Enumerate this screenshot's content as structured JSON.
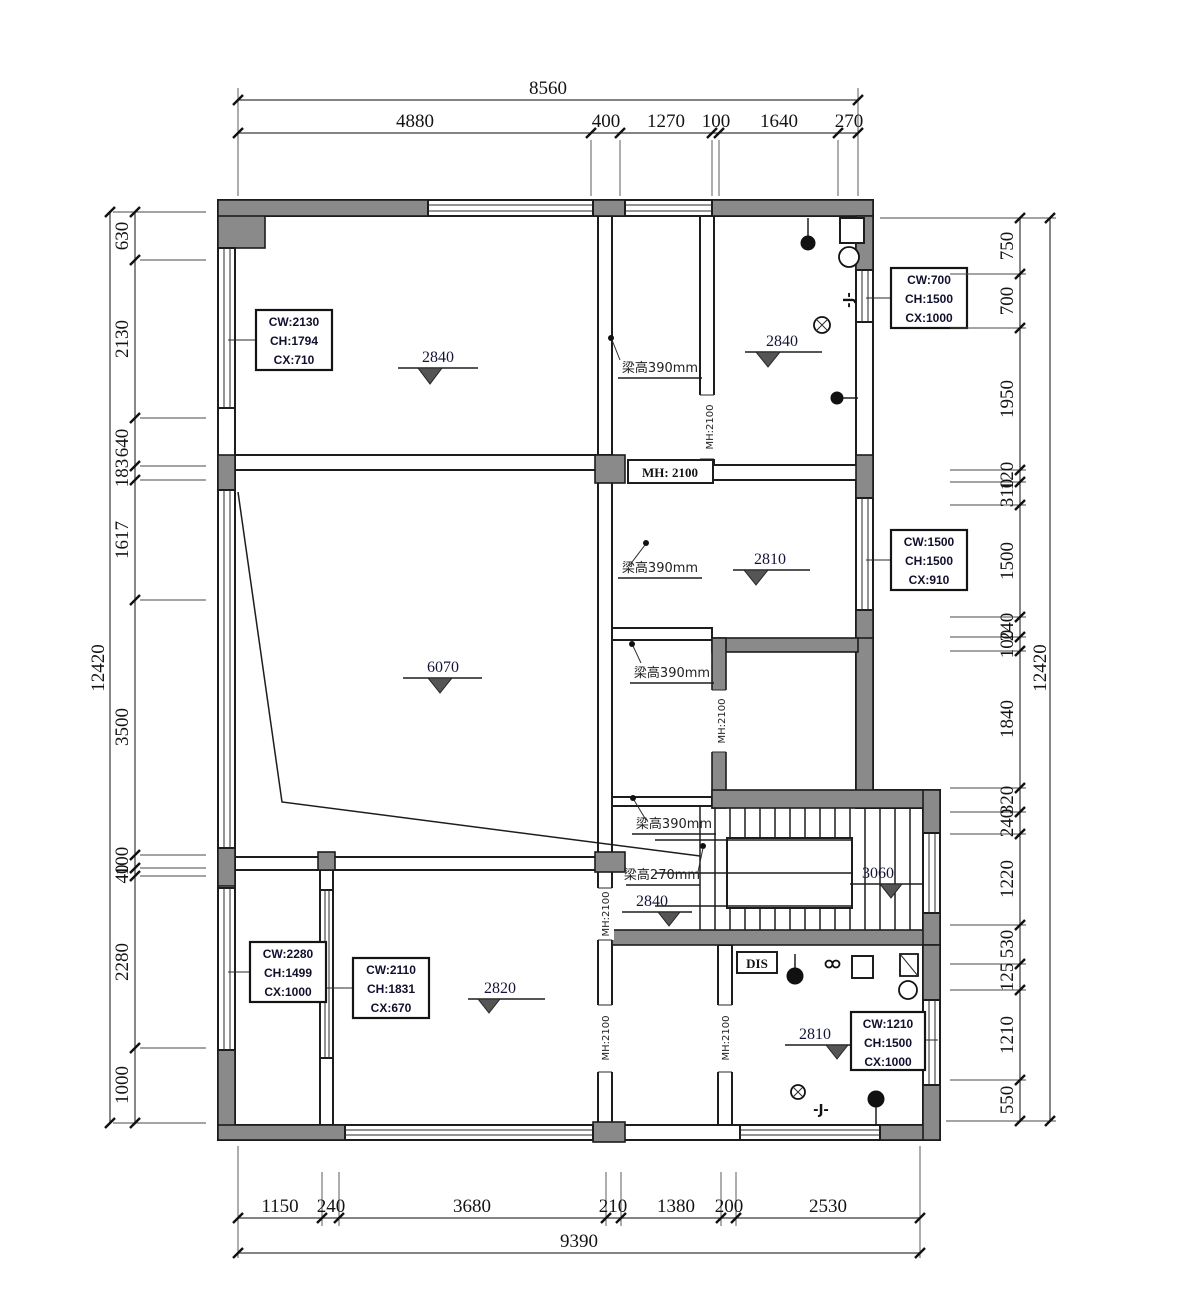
{
  "dims": {
    "top": {
      "overall": "8560",
      "segs": [
        "4880",
        "400",
        "1270",
        "100",
        "1640",
        "270"
      ]
    },
    "bottom": {
      "overall": "9390",
      "segs": [
        "1150",
        "240",
        "3680",
        "210",
        "1380",
        "200",
        "2530"
      ]
    },
    "left": {
      "overall": "12420",
      "segs": [
        "630",
        "2130",
        "640",
        "183",
        "1617",
        "3500",
        "100",
        "40",
        "2280",
        "1000"
      ]
    },
    "right": {
      "overall": "12420",
      "segs": [
        "750",
        "700",
        "1950",
        "120",
        "310",
        "1500",
        "240",
        "100",
        "1840",
        "320",
        "240",
        "1220",
        "530",
        "125",
        "1210",
        "550"
      ]
    }
  },
  "elevations": {
    "bedroom_top": "2840",
    "bath_top": "2840",
    "room_mid": "2810",
    "living": "6070",
    "lobby": "2840",
    "stair": "3060",
    "bedroom_bottom": "2820",
    "bath_bottom": "2810"
  },
  "beams": {
    "b1": "梁高390mm",
    "b2": "梁高390mm",
    "b3": "梁高390mm",
    "b4": "梁高390mm",
    "b5": "梁高270mm"
  },
  "door_heights": {
    "head_label": "MH: 2100",
    "v1": "MH:2100",
    "v2": "MH:2100",
    "v3": "MH:2100",
    "v4": "MH:2100",
    "v5": "MH:2100"
  },
  "window_specs": {
    "w1": {
      "cw": "CW:2130",
      "ch": "CH:1794",
      "cx": "CX:710"
    },
    "w2": {
      "cw": "CW:700",
      "ch": "CH:1500",
      "cx": "CX:1000"
    },
    "w3": {
      "cw": "CW:1500",
      "ch": "CH:1500",
      "cx": "CX:910"
    },
    "w4": {
      "cw": "CW:2280",
      "ch": "CH:1499",
      "cx": "CX:1000"
    },
    "w5": {
      "cw": "CW:2110",
      "ch": "CH:1831",
      "cx": "CX:670"
    },
    "w6": {
      "cw": "CW:1210",
      "ch": "CH:1500",
      "cx": "CX:1000"
    }
  },
  "annotations": {
    "dis": "DIS",
    "j_top": "-J-",
    "j_bottom": "-J-"
  },
  "colors": {
    "wall_fill": "#8a8a8a",
    "line_color": "#1d1d1d",
    "background": "#ffffff"
  }
}
